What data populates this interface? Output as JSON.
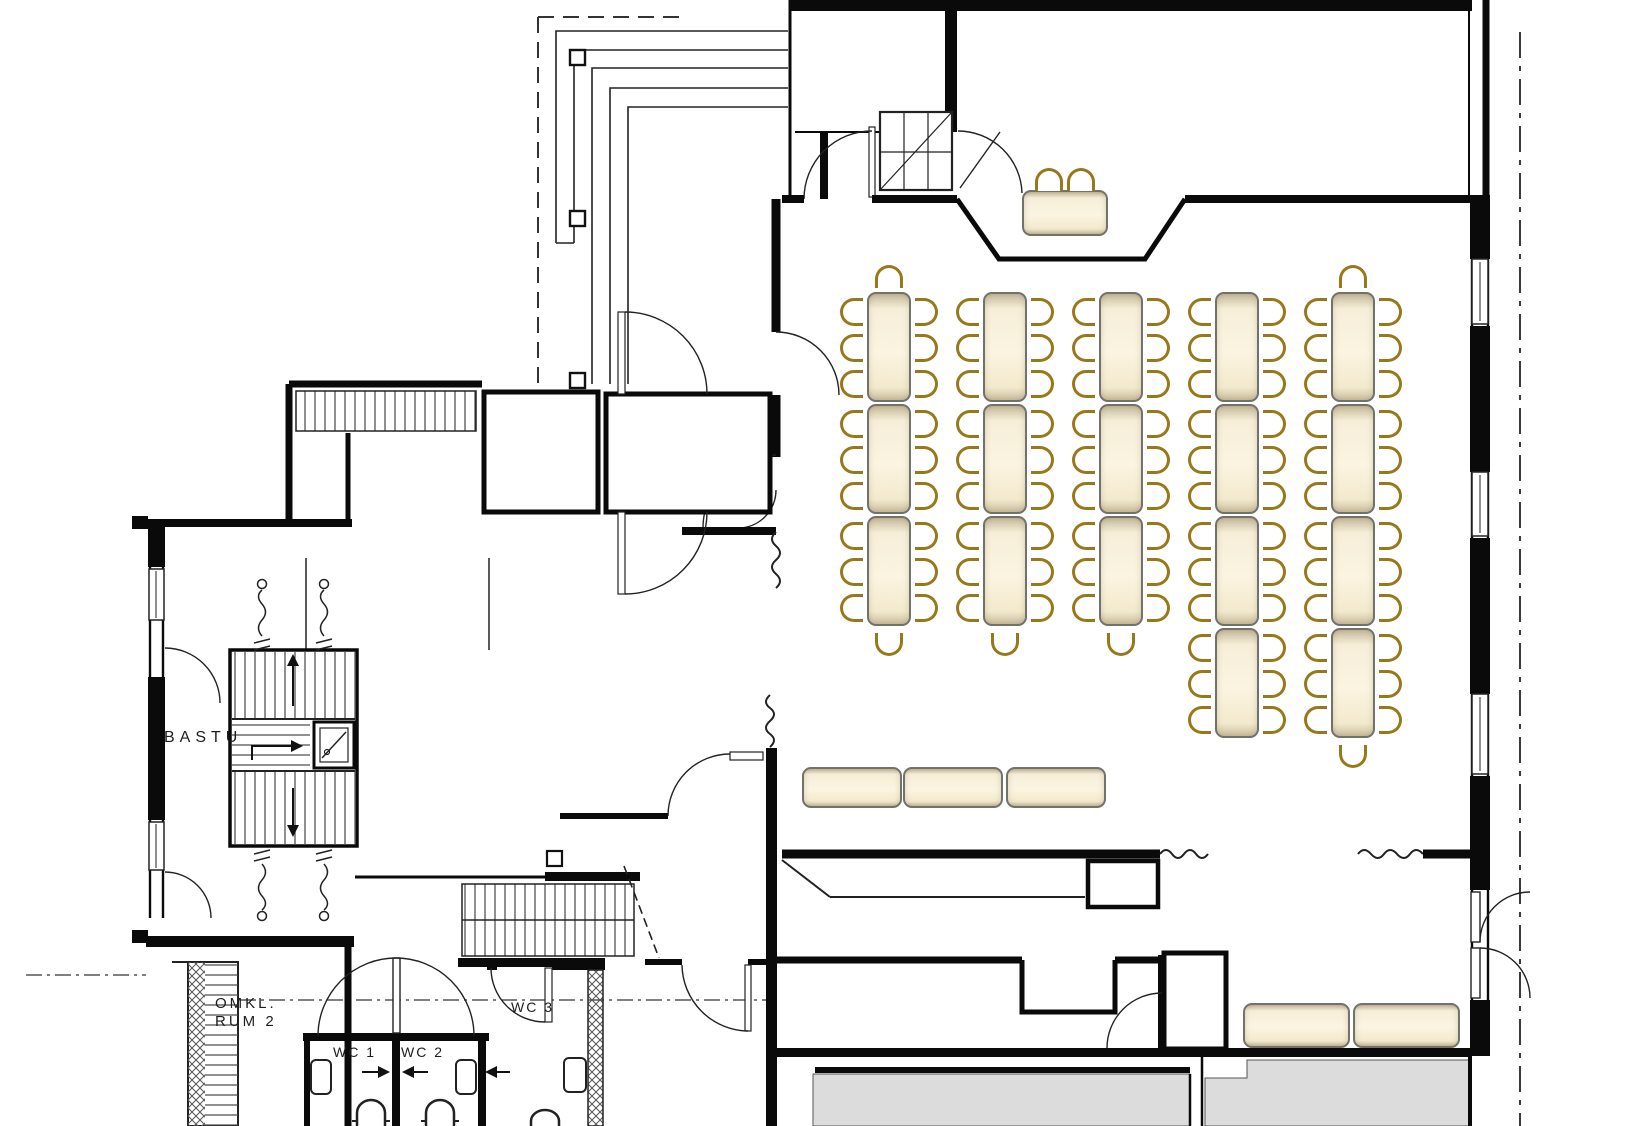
{
  "labels": {
    "bastu": "BASTU",
    "omkl_line1": "OMKL.",
    "omkl_line2": "RUM 2",
    "wc1": "WC 1",
    "wc2": "WC 2",
    "wc3": "WC 3"
  },
  "colors": {
    "table_fill": "#f8f0da",
    "table_border": "#72726c",
    "chair_stroke": "#97781a",
    "wall": "#0a0a0a",
    "terrace_gray": "#dcdcdc",
    "background": "#ffffff"
  },
  "furniture": {
    "table_size": {
      "w": 44,
      "h": 110
    },
    "columns": [
      {
        "cx": 889,
        "rows_y": [
          292,
          404,
          516
        ],
        "top_chair": true,
        "bottom_chair_y": 630
      },
      {
        "cx": 1005,
        "rows_y": [
          292,
          404,
          516
        ],
        "top_chair": false,
        "bottom_chair_y": 630
      },
      {
        "cx": 1121,
        "rows_y": [
          292,
          404,
          516
        ],
        "top_chair": false,
        "bottom_chair_y": 630
      },
      {
        "cx": 1237,
        "rows_y": [
          292,
          404,
          516,
          628
        ],
        "top_chair": false,
        "bottom_chair_y": null
      },
      {
        "cx": 1353,
        "rows_y": [
          292,
          404,
          516,
          628
        ],
        "top_chair": true,
        "bottom_chair_y": 742
      }
    ],
    "head_table": {
      "x": 1022,
      "y": 190,
      "w": 86,
      "h": 46,
      "chairs_x": [
        1034,
        1066
      ],
      "chairs_y": 164
    },
    "benches": [
      {
        "x": 802,
        "y": 767,
        "w": 100,
        "h": 41
      },
      {
        "x": 903,
        "y": 767,
        "w": 100,
        "h": 41
      },
      {
        "x": 1006,
        "y": 767,
        "w": 100,
        "h": 41
      }
    ],
    "corner_benches": [
      {
        "x": 1243,
        "y": 1003,
        "w": 107,
        "h": 45
      },
      {
        "x": 1353,
        "y": 1003,
        "w": 107,
        "h": 45
      }
    ]
  }
}
